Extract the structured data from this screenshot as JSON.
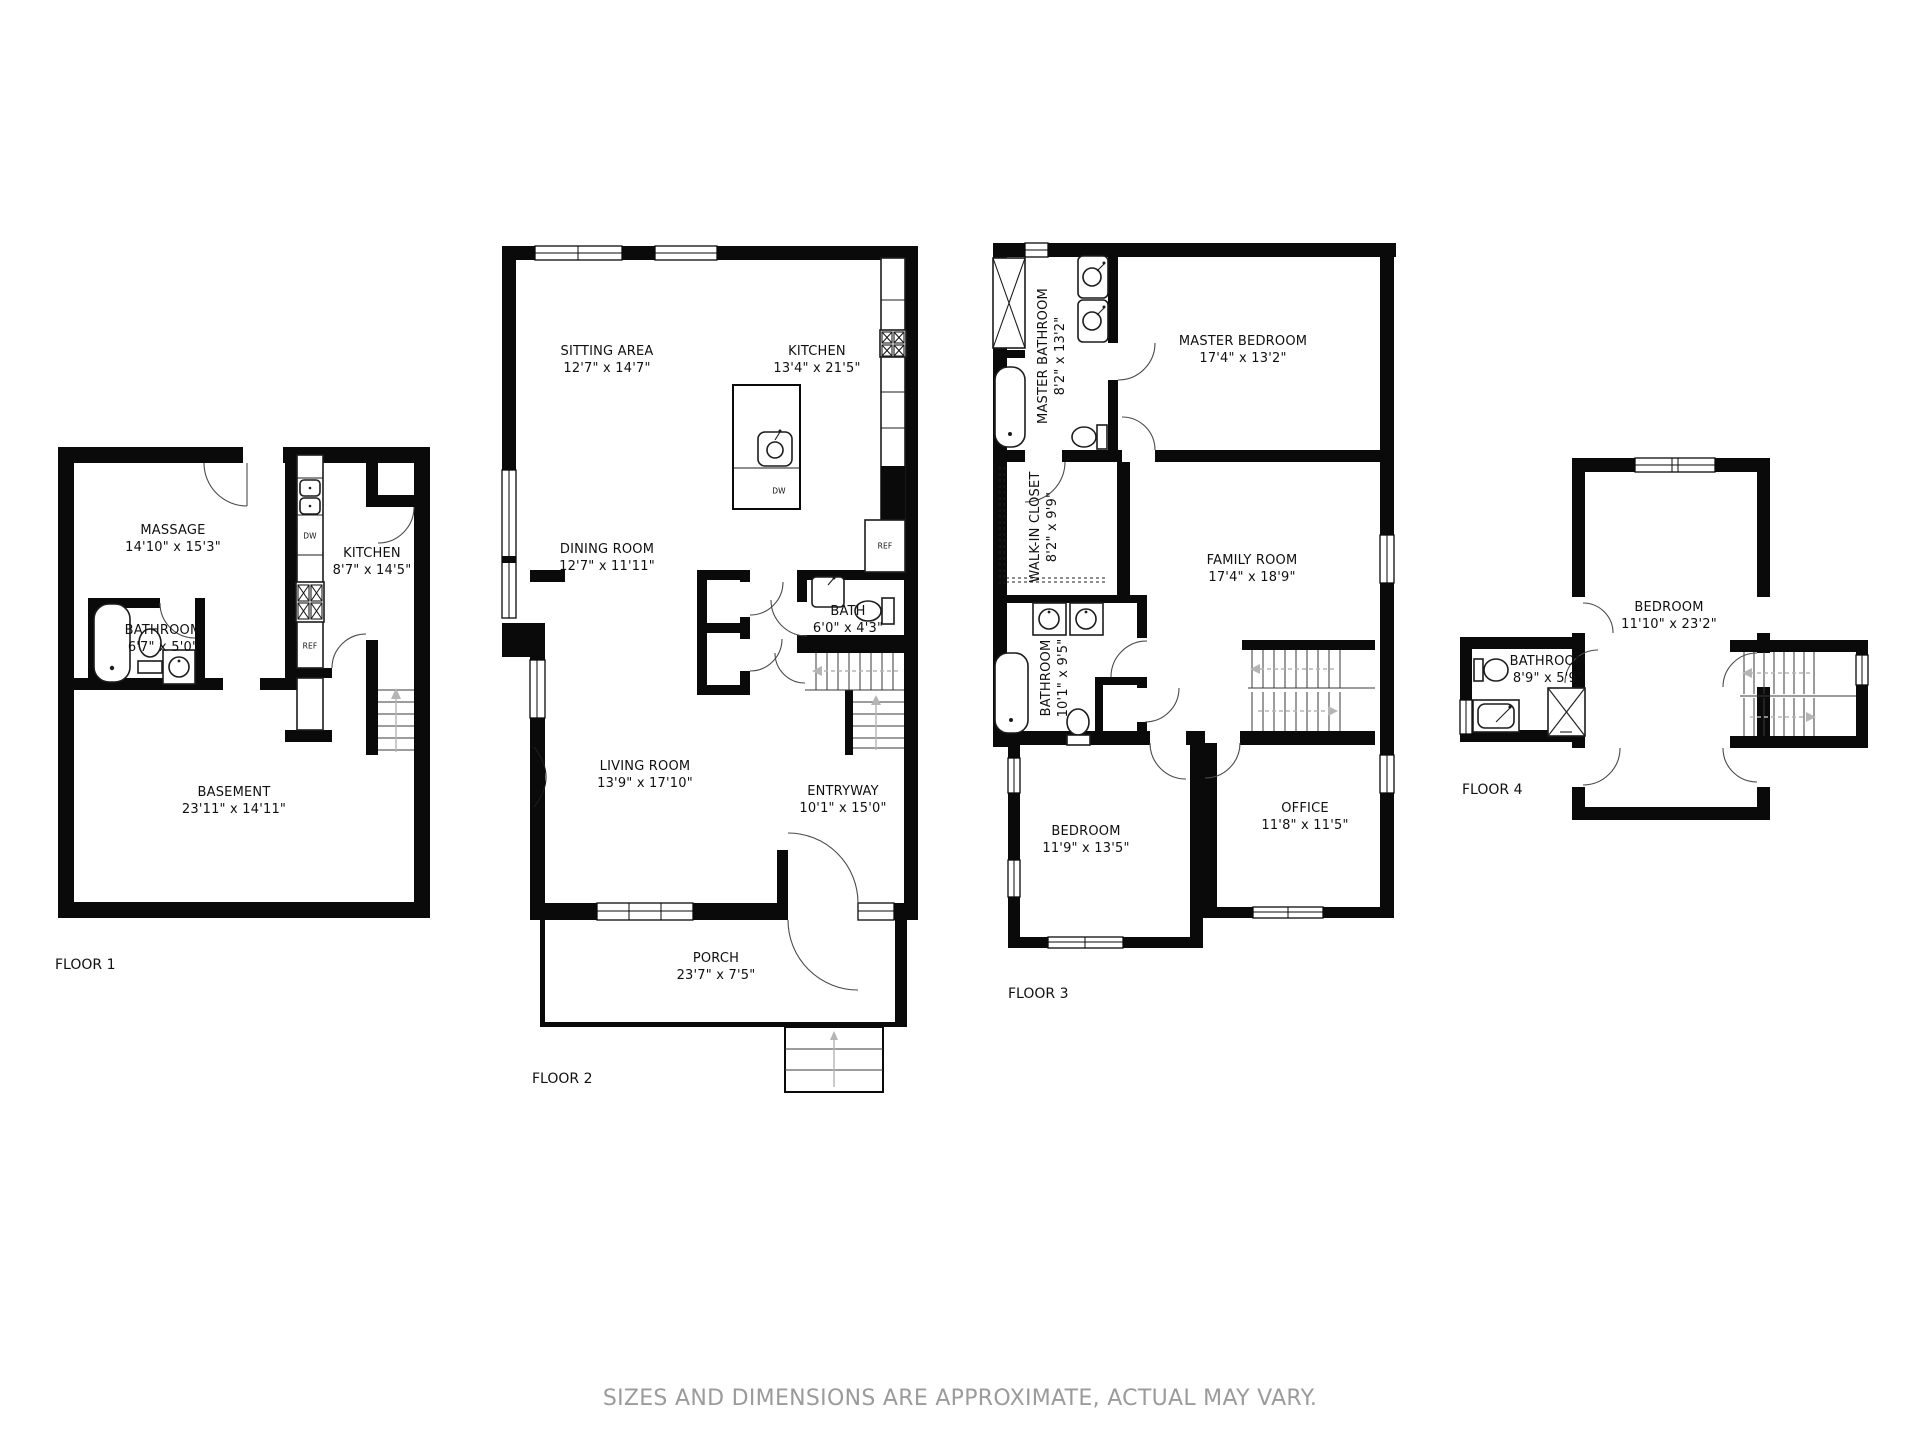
{
  "footer": {
    "disclaimer": "SIZES AND DIMENSIONS ARE APPROXIMATE, ACTUAL MAY VARY."
  },
  "floor1": {
    "label": "FLOOR 1",
    "rooms": {
      "massage": {
        "name": "MASSAGE",
        "dims": "14'10\" x 15'3\""
      },
      "kitchen": {
        "name": "KITCHEN",
        "dims": "8'7\" x 14'5\""
      },
      "bathroom": {
        "name": "BATHROOM",
        "dims": "6'7\" x 5'0\""
      },
      "basement": {
        "name": "BASEMENT",
        "dims": "23'11\" x 14'11\""
      }
    },
    "appliances": {
      "dw": "DW",
      "ref": "REF"
    }
  },
  "floor2": {
    "label": "FLOOR 2",
    "rooms": {
      "sitting": {
        "name": "SITTING AREA",
        "dims": "12'7\" x 14'7\""
      },
      "kitchen": {
        "name": "KITCHEN",
        "dims": "13'4\" x 21'5\""
      },
      "dining": {
        "name": "DINING ROOM",
        "dims": "12'7\" x 11'11\""
      },
      "bath": {
        "name": "BATH",
        "dims": "6'0\" x 4'3\""
      },
      "living": {
        "name": "LIVING ROOM",
        "dims": "13'9\" x 17'10\""
      },
      "entryway": {
        "name": "ENTRYWAY",
        "dims": "10'1\" x 15'0\""
      },
      "porch": {
        "name": "PORCH",
        "dims": "23'7\" x 7'5\""
      }
    },
    "appliances": {
      "dw": "DW",
      "ref": "REF"
    }
  },
  "floor3": {
    "label": "FLOOR 3",
    "rooms": {
      "masterbath": {
        "name": "MASTER BATHROOM",
        "dims": "8'2\" x 13'2\""
      },
      "masterbed": {
        "name": "MASTER BEDROOM",
        "dims": "17'4\" x 13'2\""
      },
      "walkin": {
        "name": "WALK-IN CLOSET",
        "dims": "8'2\" x 9'9\""
      },
      "family": {
        "name": "FAMILY ROOM",
        "dims": "17'4\" x 18'9\""
      },
      "bathroom": {
        "name": "BATHROOM",
        "dims": "10'1\" x 9'5\""
      },
      "bedroom": {
        "name": "BEDROOM",
        "dims": "11'9\" x 13'5\""
      },
      "office": {
        "name": "OFFICE",
        "dims": "11'8\" x 11'5\""
      }
    }
  },
  "floor4": {
    "label": "FLOOR 4",
    "rooms": {
      "bedroom": {
        "name": "BEDROOM",
        "dims": "11'10\" x 23'2\""
      },
      "bathroom": {
        "name": "BATHROOM",
        "dims": "8'9\" x 5'9\""
      }
    }
  }
}
